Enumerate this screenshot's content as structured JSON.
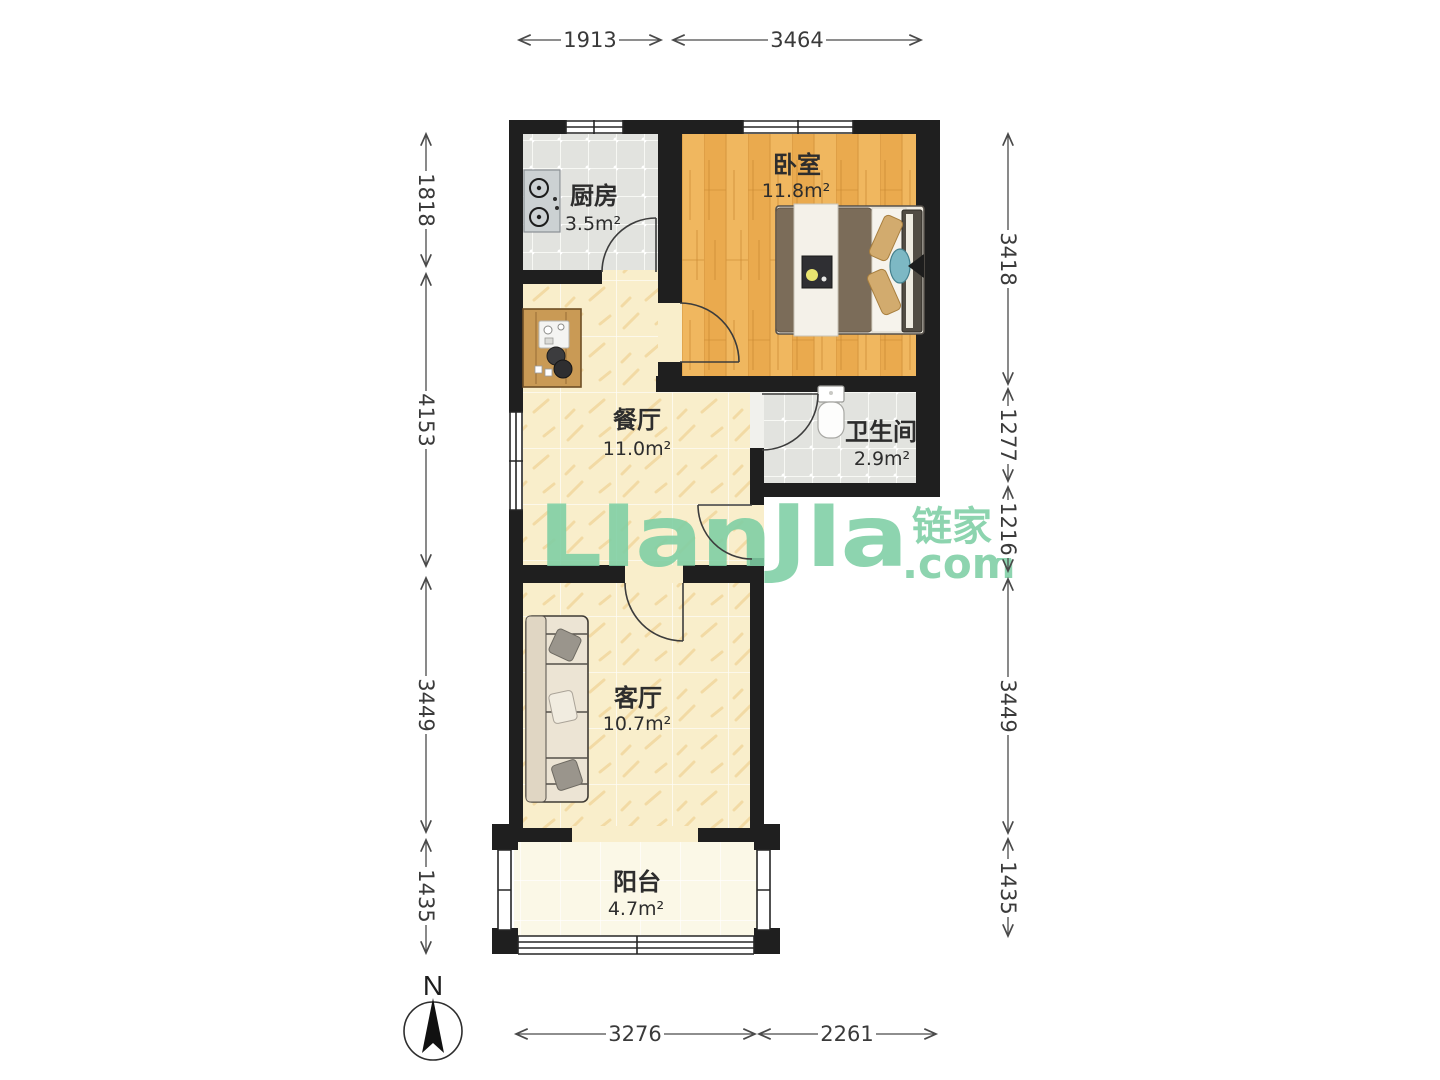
{
  "watermark": {
    "logo": "LIanJIa",
    "cjk": "链家",
    "domain": ".com",
    "color": "#7ECFA4"
  },
  "compass": {
    "label": "N"
  },
  "rooms": [
    {
      "id": "kitchen",
      "name": "厨房",
      "area": "3.5m²"
    },
    {
      "id": "bedroom",
      "name": "卧室",
      "area": "11.8m²"
    },
    {
      "id": "dining",
      "name": "餐厅",
      "area": "11.0m²"
    },
    {
      "id": "bathroom",
      "name": "卫生间",
      "area": "2.9m²"
    },
    {
      "id": "living",
      "name": "客厅",
      "area": "10.7m²"
    },
    {
      "id": "balcony",
      "name": "阳台",
      "area": "4.7m²"
    }
  ],
  "dimensions": {
    "top": [
      "1913",
      "3464"
    ],
    "left": [
      "1818",
      "4153",
      "3449",
      "1435"
    ],
    "right": [
      "3418",
      "1277",
      "1216",
      "3449",
      "1435"
    ],
    "bottom": [
      "3276",
      "2261"
    ]
  },
  "palette": {
    "wall": "#1f1f1f",
    "wood_floor": "#f0b75f",
    "tile_floor": "#e2e3df",
    "cream_floor": "#f9eecb",
    "balcony_floor": "#fbf8e7",
    "dimension_text": "#3a3a3a"
  }
}
